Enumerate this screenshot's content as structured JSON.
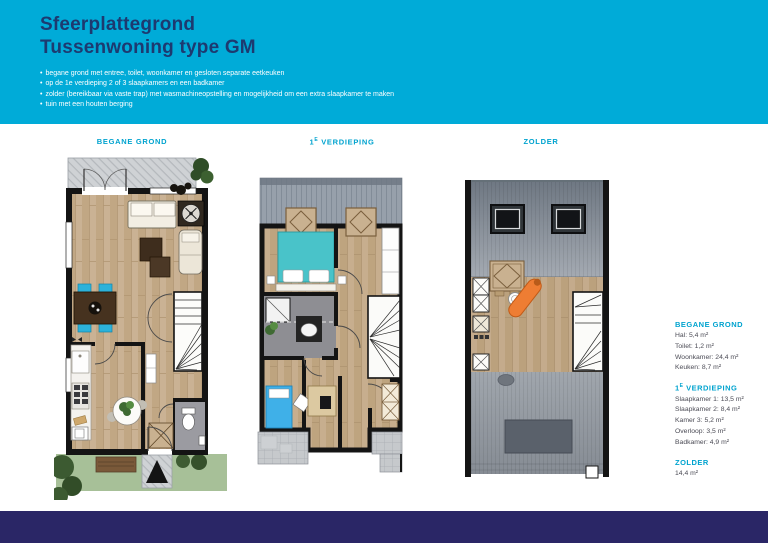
{
  "colors": {
    "brand_cyan": "#00abd8",
    "title_navy": "#1d3a70",
    "heading_cyan": "#00a3cf",
    "footer_navy": "#2a2666"
  },
  "header": {
    "title_line1": "Sfeerplattegrond",
    "title_line2": "Tussenwoning type GM",
    "bullet_char": "•",
    "bullets": [
      "begane grond met entree, toilet, woonkamer en gesloten separate eetkeuken",
      "op de 1e verdieping 2 of 3 slaapkamers en een badkamer",
      "zolder (bereikbaar via vaste trap) met wasmachineopstelling en mogelijkheid om een extra slaapkamer te maken",
      "tuin met een houten berging"
    ]
  },
  "plan_labels": {
    "ground": "Begane grond",
    "first": {
      "num": "1",
      "sup": "e",
      "rest": " verdieping"
    },
    "attic": "Zolder"
  },
  "legend": {
    "ground": {
      "heading": "Begane grond",
      "items": [
        "Hal: 5,4 m²",
        "Toilet: 1,2 m²",
        "Woonkamer: 24,4 m²",
        "Keuken: 8,7 m²"
      ]
    },
    "first": {
      "heading_num": "1",
      "heading_sup": "e",
      "heading_rest": " verdieping",
      "items": [
        "Slaapkamer 1: 13,5 m²",
        "Slaapkamer 2: 8,4 m²",
        "Kamer 3: 5,2 m²",
        "Overloop: 3,5 m²",
        "Badkamer: 4,9 m²"
      ]
    },
    "attic": {
      "heading": "Zolder",
      "items": [
        "14,4 m²"
      ]
    }
  }
}
